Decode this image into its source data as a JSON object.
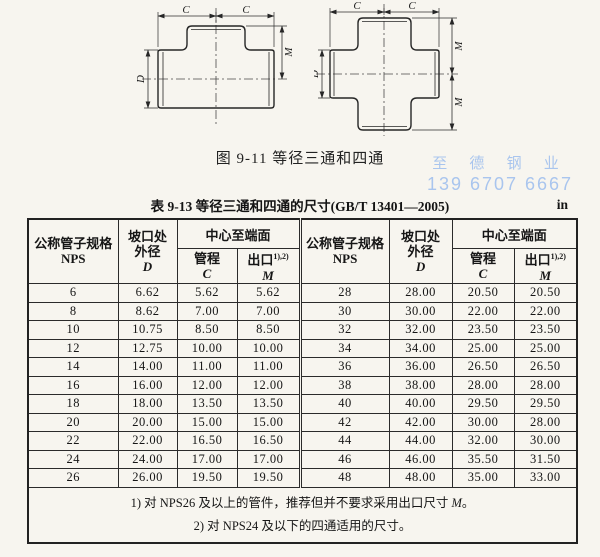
{
  "figure": {
    "caption": "图 9-11  等径三通和四通",
    "dim_c": "C",
    "dim_m": "M",
    "dim_d": "D"
  },
  "watermark": {
    "line1": "至 德 钢 业",
    "line2": "139 6707 6667",
    "color": "#a9c5ee"
  },
  "table": {
    "title": "表 9-13  等径三通和四通的尺寸(GB/T 13401—2005)",
    "unit": "in",
    "header": {
      "nps_line1": "公称管子规格",
      "nps_line2": "NPS",
      "d_line1": "坡口处",
      "d_line2": "外径",
      "d_sym": "D",
      "center": "中心至端面",
      "c_label": "管程",
      "c_sym": "C",
      "m_label": "出口",
      "m_sup": "1),2)",
      "m_sym": "M"
    },
    "rows": [
      {
        "l": [
          "6",
          "6.62",
          "5.62",
          "5.62"
        ],
        "r": [
          "28",
          "28.00",
          "20.50",
          "20.50"
        ]
      },
      {
        "l": [
          "8",
          "8.62",
          "7.00",
          "7.00"
        ],
        "r": [
          "30",
          "30.00",
          "22.00",
          "22.00"
        ]
      },
      {
        "l": [
          "10",
          "10.75",
          "8.50",
          "8.50"
        ],
        "r": [
          "32",
          "32.00",
          "23.50",
          "23.50"
        ]
      },
      {
        "l": [
          "12",
          "12.75",
          "10.00",
          "10.00"
        ],
        "r": [
          "34",
          "34.00",
          "25.00",
          "25.00"
        ]
      },
      {
        "l": [
          "14",
          "14.00",
          "11.00",
          "11.00"
        ],
        "r": [
          "36",
          "36.00",
          "26.50",
          "26.50"
        ]
      },
      {
        "l": [
          "16",
          "16.00",
          "12.00",
          "12.00"
        ],
        "r": [
          "38",
          "38.00",
          "28.00",
          "28.00"
        ]
      },
      {
        "l": [
          "18",
          "18.00",
          "13.50",
          "13.50"
        ],
        "r": [
          "40",
          "40.00",
          "29.50",
          "29.50"
        ]
      },
      {
        "l": [
          "20",
          "20.00",
          "15.00",
          "15.00"
        ],
        "r": [
          "42",
          "42.00",
          "30.00",
          "28.00"
        ]
      },
      {
        "l": [
          "22",
          "22.00",
          "16.50",
          "16.50"
        ],
        "r": [
          "44",
          "44.00",
          "32.00",
          "30.00"
        ]
      },
      {
        "l": [
          "24",
          "24.00",
          "17.00",
          "17.00"
        ],
        "r": [
          "46",
          "46.00",
          "35.50",
          "31.50"
        ]
      },
      {
        "l": [
          "26",
          "26.00",
          "19.50",
          "19.50"
        ],
        "r": [
          "48",
          "48.00",
          "35.00",
          "33.00"
        ]
      }
    ],
    "notes": {
      "n1_pre": "1) 对 NPS26 及以上的管件，推荐但并不要求采用出口尺寸 ",
      "n1_var": "M",
      "n1_post": "。",
      "n2": "2) 对 NPS24 及以下的四通适用的尺寸。"
    }
  }
}
